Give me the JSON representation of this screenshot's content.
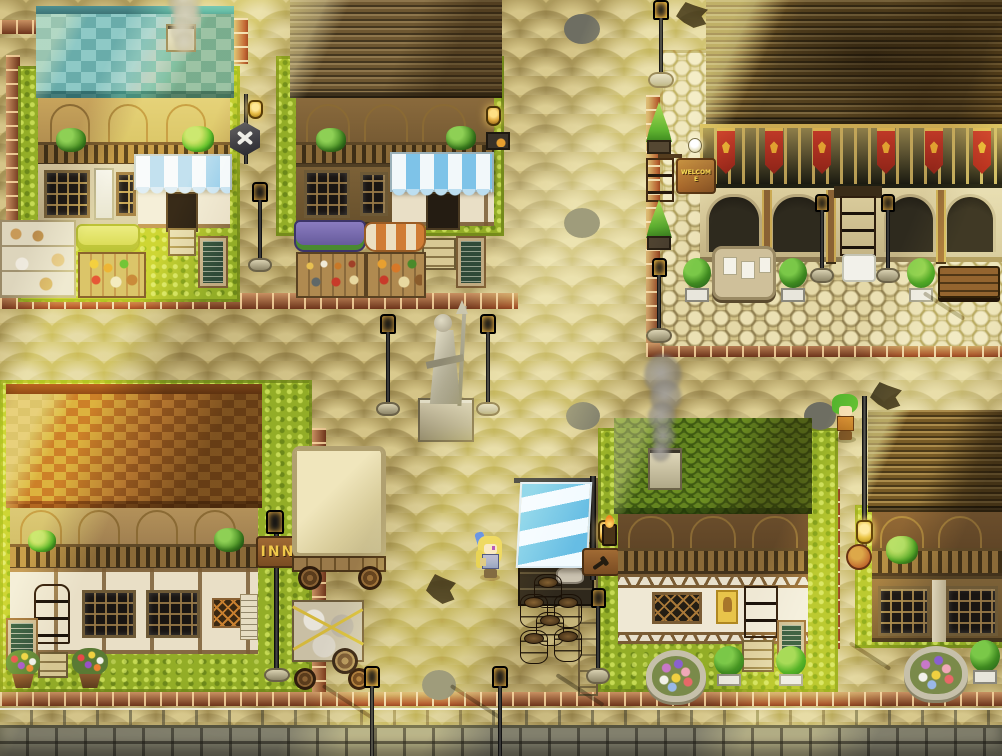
{
  "scene": {
    "name": "Fantasy town market plaza (top-down RPG map)",
    "lighting": "sunny afternoon, diagonal light shafts from upper right",
    "ground": "tan cobblestone streets, red brick borders, stone retaining wall along bottom edge"
  },
  "signs": {
    "inn": {
      "text": "INN",
      "color": "#f0c84a"
    },
    "welcome": {
      "text": "WELCOME",
      "color": "#e8b040"
    },
    "blacksmith": {
      "icon": "hammer-icon"
    },
    "toolsmith": {
      "icon": "hammer-pick-icon"
    },
    "round_shop": {
      "icon": "round-emblem-icon"
    }
  },
  "characters": [
    {
      "id": "blonde-villager",
      "hair": "#e2bf4e",
      "accessory": "blue hair ribbon",
      "outfit": "#8890c4",
      "location": "plaza west of barrel stand flag"
    },
    {
      "id": "green-haired-villager",
      "hair": "#55b52e",
      "outfit": "#d08030",
      "location": "street corner beside manhole, northeast of green-roof tavern"
    }
  ],
  "buildings": [
    {
      "id": "teal-roof-shop",
      "roof_color": "#79b9b4",
      "features": [
        "smoking chimney",
        "arched gallery with hanging plants",
        "blue-white striped awning",
        "bakery shelf stall",
        "green canopy stall",
        "menu chalkboard"
      ]
    },
    {
      "id": "market-hall",
      "roof_color": "#6e5731",
      "features": [
        "arched gallery with hanging plants",
        "blue-white striped awning",
        "purple canopy potion stall",
        "orange striped produce stall",
        "menu chalkboard",
        "stone steps"
      ]
    },
    {
      "id": "banner-hall",
      "roof_color": "#57431f",
      "features": [
        "six red banners with gold crest",
        "gold-trimmed balcony",
        "stone arcade",
        "wooden door with two lamps",
        "notice board",
        "bench",
        "topiaries",
        "white door mat",
        "welcome sign"
      ]
    },
    {
      "id": "inn",
      "roof_color": "#a8672f",
      "sign": "INN",
      "features": [
        "four arched windows",
        "balcony with hanging plants",
        "wooden door",
        "menu chalkboard",
        "flower pots",
        "hanging INN sign on lamp post"
      ]
    },
    {
      "id": "green-roof-tavern",
      "roof_color": "#4d6b18",
      "features": [
        "smoking chimney",
        "half-timbered wall",
        "diamond lattice window",
        "yellow poster",
        "wooden door",
        "menu chalkboard",
        "round flower bed",
        "topiaries",
        "wall torch",
        "barrel stand with striped flag"
      ]
    },
    {
      "id": "timber-house",
      "roof_color": "#57431f",
      "features": [
        "balcony with plant",
        "two lattice windows",
        "round hanging shop sign",
        "round flower bed",
        "topiary"
      ]
    }
  ],
  "props": {
    "statue": "stone statue of robed figure holding a spear, on square pedestal, flanked by two iron lamps",
    "street_lamps": 11,
    "manhole_covers": 5,
    "pavement_cracks": 3,
    "covered_wagon": "cream canvas wagon with luggage cart roped in yellow",
    "barrel_stand": "stacked barrels under blue-white striped banner",
    "flower_beds": 2,
    "flower_pots": 2,
    "benches": 1,
    "notice_boards": 1,
    "smoke_plumes": 2
  },
  "palette": {
    "street": "#c9b674",
    "grass": "#93ad27",
    "brick": "#9c4a26",
    "teal_roof": "#79b9b4",
    "orange_roof": "#a8672f",
    "green_roof": "#4d6b18",
    "dark_roof": "#57431f",
    "banner_red": "#b03024",
    "awning_blue": "#7ec3e8",
    "light_shaft": "#fff6c8"
  }
}
